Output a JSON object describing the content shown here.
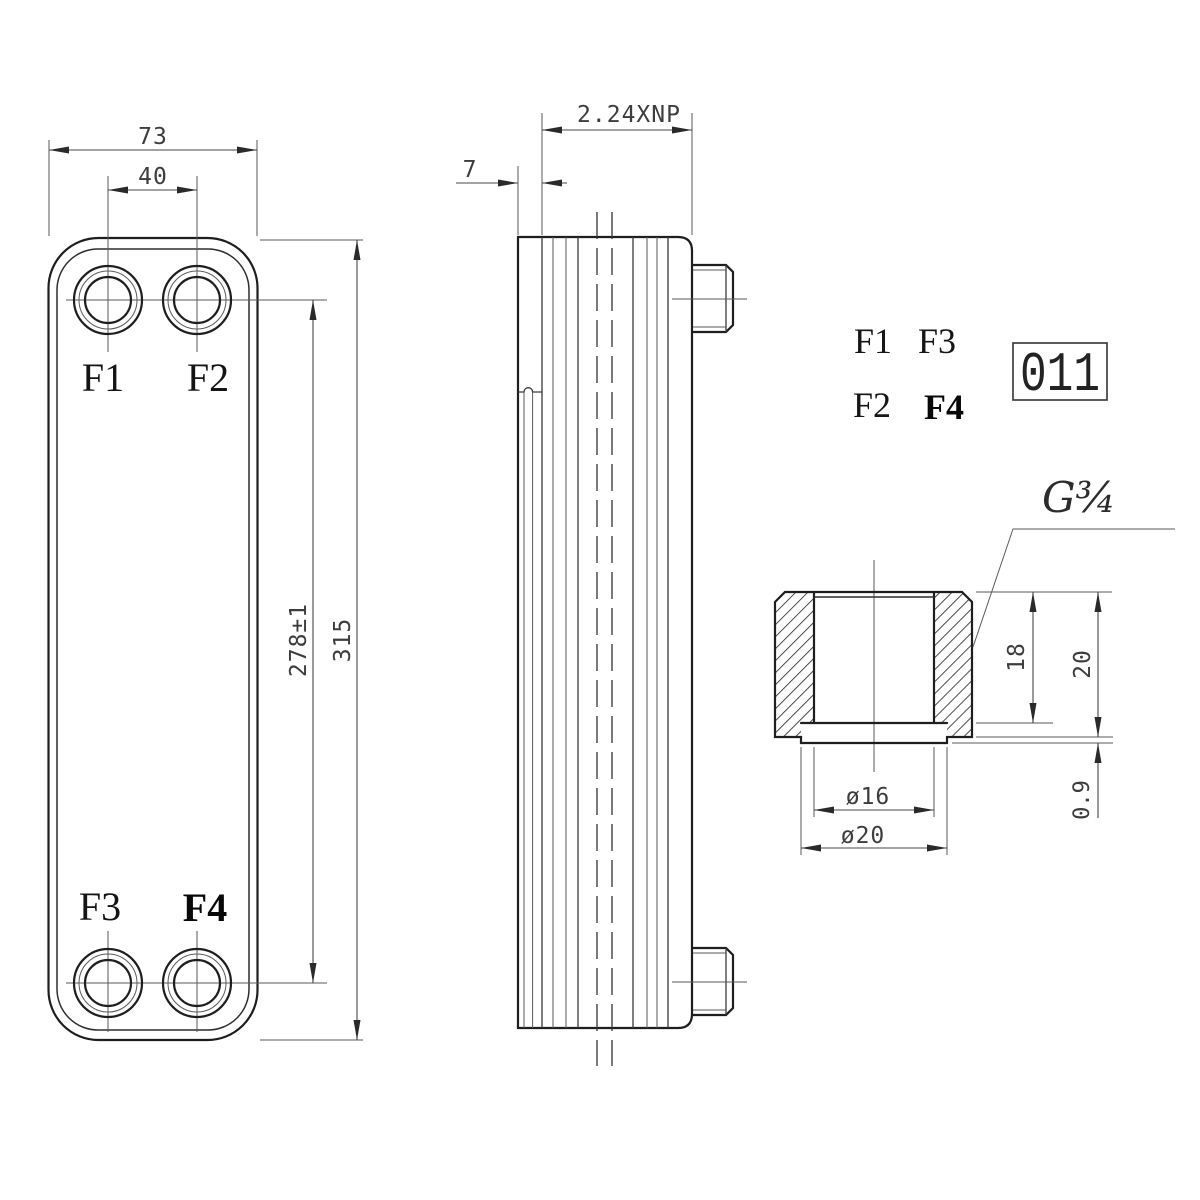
{
  "front_view": {
    "dim_overall_width": "73",
    "dim_port_spacing_horizontal": "40",
    "dim_port_spacing_vertical": "278±1",
    "dim_overall_height": "315",
    "port_f1": "F1",
    "port_f2": "F2",
    "port_f3": "F3",
    "port_f4": "F4"
  },
  "side_view": {
    "dim_plate_stack": "2.24XNP",
    "dim_end_plate": "7"
  },
  "port_legend": {
    "row1_col1": "F1",
    "row1_col2": "F3",
    "row2_col1": "F2",
    "row2_col2": "F4",
    "part_code": "011"
  },
  "fitting_detail": {
    "thread_label": "G¾",
    "dim_thread_depth": "18",
    "dim_total_height": "20",
    "dim_lip_thickness": "0.9",
    "dim_bore_diameter": "ø16",
    "dim_neck_diameter": "ø20"
  }
}
